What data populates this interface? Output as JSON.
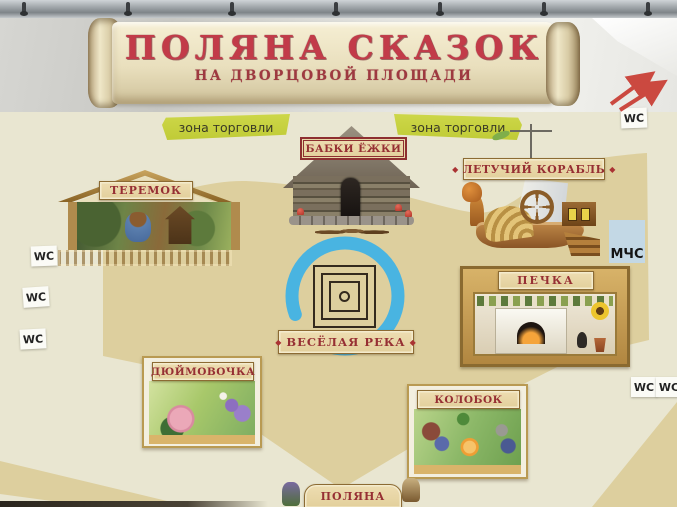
{
  "banner": {
    "title": "ПОЛЯНА СКАЗОК",
    "subtitle": "НА ДВОРЦОВОЙ ПЛОЩАДИ"
  },
  "trade_zones": {
    "left": "зона торговли",
    "right": "зона торговли"
  },
  "attractions": {
    "teremok": {
      "label": "ТЕРЕМОК"
    },
    "babki_ezhki": {
      "label": "БАБКИ ЁЖКИ"
    },
    "letuchiy_korabl": {
      "label": "ЛЕТУЧИЙ КОРАБЛЬ"
    },
    "pechka": {
      "label": "ПЕЧКА"
    },
    "veselaya_reka": {
      "label": "ВЕСЁЛАЯ РЕКА"
    },
    "dyuymovochka": {
      "label": "ДЮЙМОВОЧКА"
    },
    "kolobok": {
      "label": "КОЛОБОК"
    },
    "polyana": {
      "label": "ПОЛЯНА"
    }
  },
  "service_labels": {
    "wc": "WC",
    "mchs": "МЧС"
  },
  "colors": {
    "title_red": "#c23b49",
    "subtitle_red": "#9e3940",
    "sign_text_red": "#962f33",
    "sign_beige": "#eeddb2",
    "trade_zone_green": "#c0cb37",
    "river_blue": "#49b4e1",
    "mchs_blue": "#c3d8e5",
    "arrow_red": "#cb4940",
    "board_cream": "#e9e6d1",
    "plaza_tan": "#ddcf9e"
  }
}
